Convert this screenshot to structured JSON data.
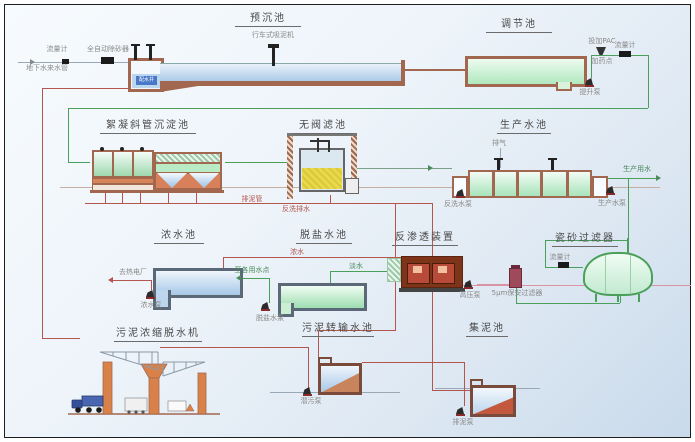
{
  "canvas": {
    "width": 695,
    "height": 442
  },
  "colors": {
    "pipe_sludge": "#b3564e",
    "pipe_water": "#4aa05a",
    "wall_brown": "#a2674f",
    "water_blue": "#bcd6ee",
    "water_green": "#b9ecc4",
    "ro_body": "#7e3418"
  },
  "inlet": {
    "meter_label": "流量计",
    "source_label": "地下水来水管",
    "separator_label": "全自动除砂器"
  },
  "u": {
    "presed": {
      "title": "预沉池",
      "machine": "行车式吸泥机",
      "well": "配水井"
    },
    "regulating": {
      "title": "调节池",
      "pump": "提升泵",
      "dosing": "投加PAC",
      "dosing_point": "加药点",
      "meter": "流量计"
    },
    "floc": {
      "title": "絮凝斜管沉淀池",
      "drain": "排泥管"
    },
    "valveless": {
      "title": "无阀滤池",
      "backwash": "反洗排水"
    },
    "product": {
      "title": "生产水池",
      "vent": "排气",
      "pump_left": "反洗水泵",
      "pump_right": "生产水泵",
      "outflow": "生产用水"
    },
    "concentrate": {
      "title": "浓水池",
      "pump": "浓水泵",
      "outflow": "去热电厂",
      "line": "浓水"
    },
    "desalted": {
      "title": "脱盐水池",
      "pump": "脱盐水泵",
      "outflow": "至各用水点",
      "line": "淡水"
    },
    "ro": {
      "title": "反渗透装置",
      "pump": "高压泵",
      "prefilter": "5μm保安过滤器"
    },
    "ceramic": {
      "title": "瓷砂过滤器",
      "meter": "流量计"
    },
    "dewater": {
      "title": "污泥浓缩脱水机"
    },
    "transfer": {
      "title": "污泥转输水池",
      "pump": "潜污泵"
    },
    "collect": {
      "title": "集泥池",
      "pump": "排泥泵"
    }
  }
}
